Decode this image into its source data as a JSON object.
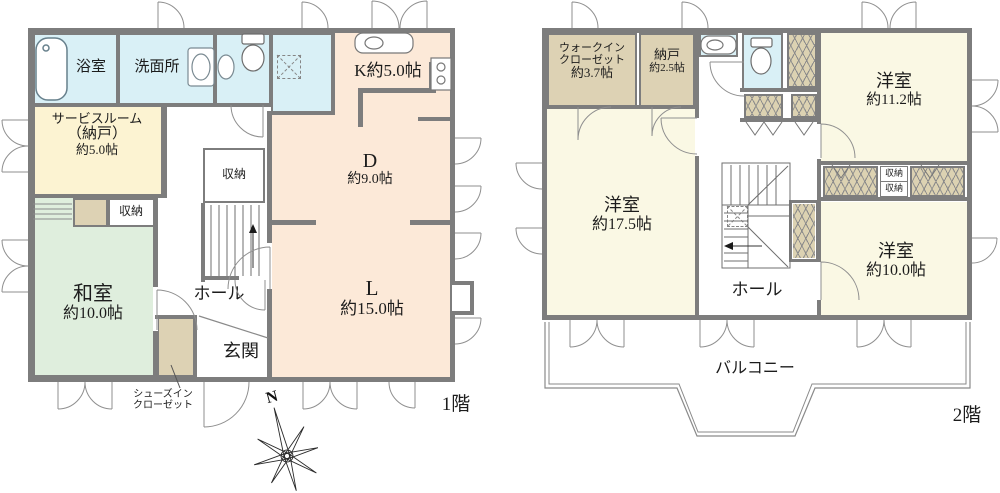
{
  "colors": {
    "wall": "#7d7d7d",
    "water_blue": "#d9f0f6",
    "ldk_peach": "#fce9d8",
    "service_cream": "#fcf3d2",
    "tatami_green": "#dfeedd",
    "closet_tan": "#ddd2b4",
    "bedroom_pale_yellow": "#faf8e4"
  },
  "floor1": {
    "title": "1階",
    "compass_north": "N",
    "bath": "浴室",
    "washroom": "洗面所",
    "service_room": {
      "line1": "サービスルーム",
      "line2": "（納戸）",
      "line3": "約5.0帖"
    },
    "kitchen": "K約5.0帖",
    "dining": {
      "line1": "D",
      "line2": "約9.0帖"
    },
    "living": {
      "line1": "L",
      "line2": "約15.0帖"
    },
    "washitsu": {
      "line1": "和室",
      "line2": "約10.0帖"
    },
    "closet_by_stairs": "収納",
    "closet_washitsu": "収納",
    "hall": "ホール",
    "entrance": "玄関",
    "shoes_closet": {
      "line1": "シューズイン",
      "line2": "クローゼット"
    }
  },
  "floor2": {
    "title": "2階",
    "walk_in_closet": {
      "line1": "ウォークイン",
      "line2": "クローゼット",
      "line3": "約3.7帖"
    },
    "nando": {
      "line1": "納戸",
      "line2": "約2.5帖"
    },
    "bedroom_ne": {
      "line1": "洋室",
      "line2": "約11.2帖"
    },
    "bedroom_w": {
      "line1": "洋室",
      "line2": "約17.5帖"
    },
    "bedroom_se": {
      "line1": "洋室",
      "line2": "約10.0帖"
    },
    "closet_small_a": "収納",
    "closet_small_b": "収納",
    "hall": "ホール",
    "balcony": "バルコニー"
  }
}
